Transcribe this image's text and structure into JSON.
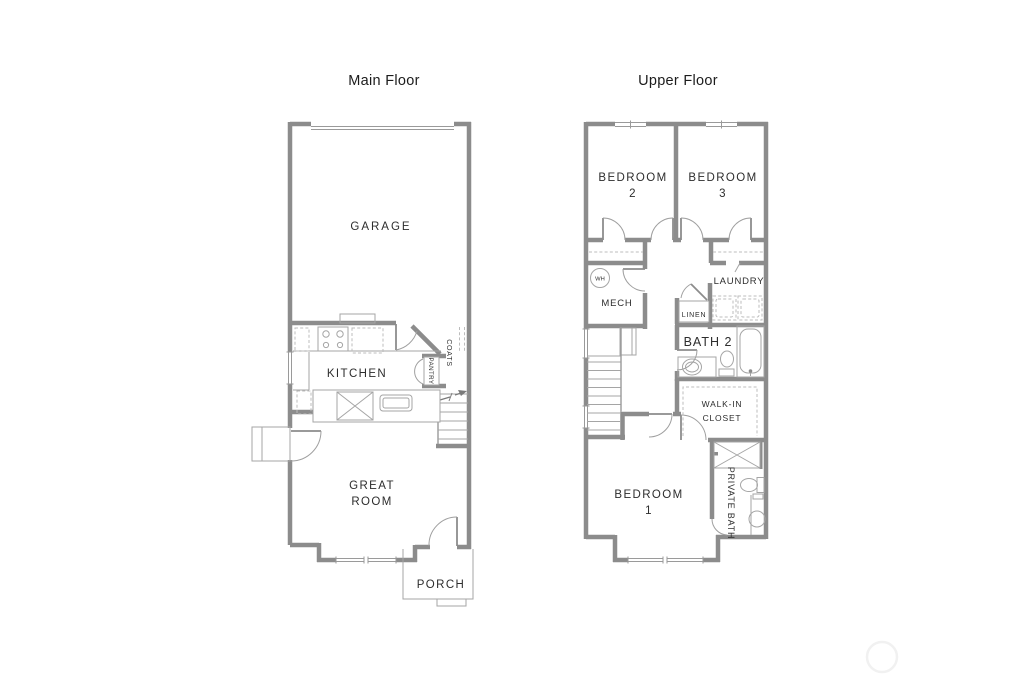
{
  "page": {
    "background_color": "#ffffff"
  },
  "colors": {
    "wall": "#8c8c8c",
    "fixture_line": "#a5a5a5",
    "dashed_line": "#bcbcbc",
    "label_text": "#2d2d2d",
    "title_text": "#1c1c1c",
    "watermark": "#f1f1f1"
  },
  "main_floor": {
    "title": "Main Floor",
    "labels": {
      "garage": "GARAGE",
      "kitchen": "KITCHEN",
      "great_room_line1": "GREAT",
      "great_room_line2": "ROOM",
      "porch": "PORCH",
      "coats": "COATS",
      "pantry": "PANTRY"
    }
  },
  "upper_floor": {
    "title": "Upper Floor",
    "labels": {
      "bedroom2_line1": "BEDROOM",
      "bedroom2_line2": "2",
      "bedroom3_line1": "BEDROOM",
      "bedroom3_line2": "3",
      "bedroom1_line1": "BEDROOM",
      "bedroom1_line2": "1",
      "mech": "MECH",
      "water_heater": "WH",
      "laundry": "LAUNDRY",
      "linen": "LINEN",
      "bath2": "BATH 2",
      "walkin_line1": "WALK-IN",
      "walkin_line2": "CLOSET",
      "private_bath": "PRIVATE BATH"
    }
  }
}
